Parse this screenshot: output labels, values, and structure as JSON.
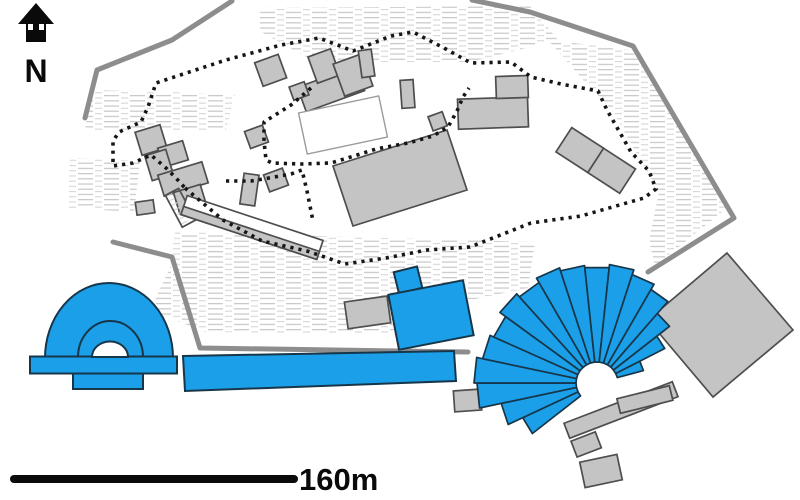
{
  "compass": {
    "icon": "north-arrow-icon",
    "label": "N"
  },
  "scale_bar": {
    "label": "160m"
  },
  "colors": {
    "highlight_blue": "#1A9FE8",
    "structure_gray": "#C4C4C4",
    "structure_outline": "#4E4E4E",
    "blue_outline": "#17364A",
    "boundary_gray": "#8D8D8D",
    "dotted_black": "#161616",
    "hatch_gray": "#C9C9C9",
    "foundation_white": "#FFFFFF",
    "ink_black": "#0A0A0A",
    "background_white": "#FFFFFF"
  }
}
